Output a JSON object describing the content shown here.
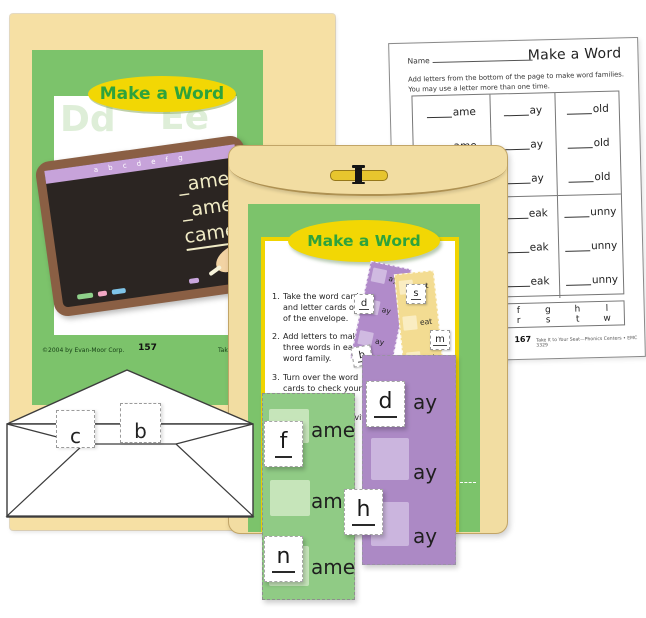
{
  "colors": {
    "folder_cream": "#F6E0A4",
    "envelope_manila": "#F2DDA2",
    "card_green": "#7CC36B",
    "banner_yellow": "#F2D704",
    "title_green": "#2EA33C",
    "strip_green": "#90CB85",
    "strip_purple": "#AC89C5",
    "board_black": "#2B2522",
    "frame_brown": "#8A5F44",
    "chalk_cream": "#F1ECC6"
  },
  "folder": {
    "title": "Make a Word",
    "ghost_letters": [
      "Dd",
      "Ee",
      "Cc",
      "Aa"
    ],
    "chalk_alphabet": "a b c d e f g",
    "chalk_lines": [
      "_ame",
      "_ame",
      "came"
    ],
    "copyright": "©2004 by Evan-Moor Corp.",
    "page_number": "157",
    "edition_text": "Take It to Your Seat"
  },
  "activity_card": {
    "title": "Make a Word",
    "steps": [
      {
        "num": "1.",
        "text": "Take the word cards and letter cards out of the envelope."
      },
      {
        "num": "2.",
        "text": "Add letters to make three words in each word family."
      },
      {
        "num": "3.",
        "text": "Turn over the word cards to check your answers."
      },
      {
        "num": "4.",
        "text": "Complete the activity sheet."
      }
    ],
    "mini_purple": {
      "suffix": "ay",
      "card": "d"
    },
    "mini_yellow": {
      "suffix": "eat",
      "cards": [
        "s",
        "m"
      ]
    },
    "loose_card": "b"
  },
  "worksheet": {
    "name_label": "Name",
    "title": "Make a Word",
    "instructions": [
      "Add letters from the bottom of the page to make word families.",
      "You may use a letter more than one time."
    ],
    "families_top": [
      "ame",
      "ay",
      "old"
    ],
    "families_bottom": [
      "eak",
      "unny"
    ],
    "letter_bank": [
      [
        "f",
        "g",
        "h",
        "l"
      ],
      [
        "r",
        "s",
        "t",
        "w"
      ]
    ],
    "page_number": "167",
    "footer": "Take It to Your Seat—Phonics Centers • EMC 3329"
  },
  "paper_envelope": {
    "cards": [
      "c",
      "b"
    ]
  },
  "word_strips": {
    "green": {
      "suffix": "ame",
      "card_top": "f",
      "card_bottom": "n"
    },
    "purple": {
      "suffix": "ay",
      "card_top": "d",
      "card_bottom": "h"
    }
  }
}
